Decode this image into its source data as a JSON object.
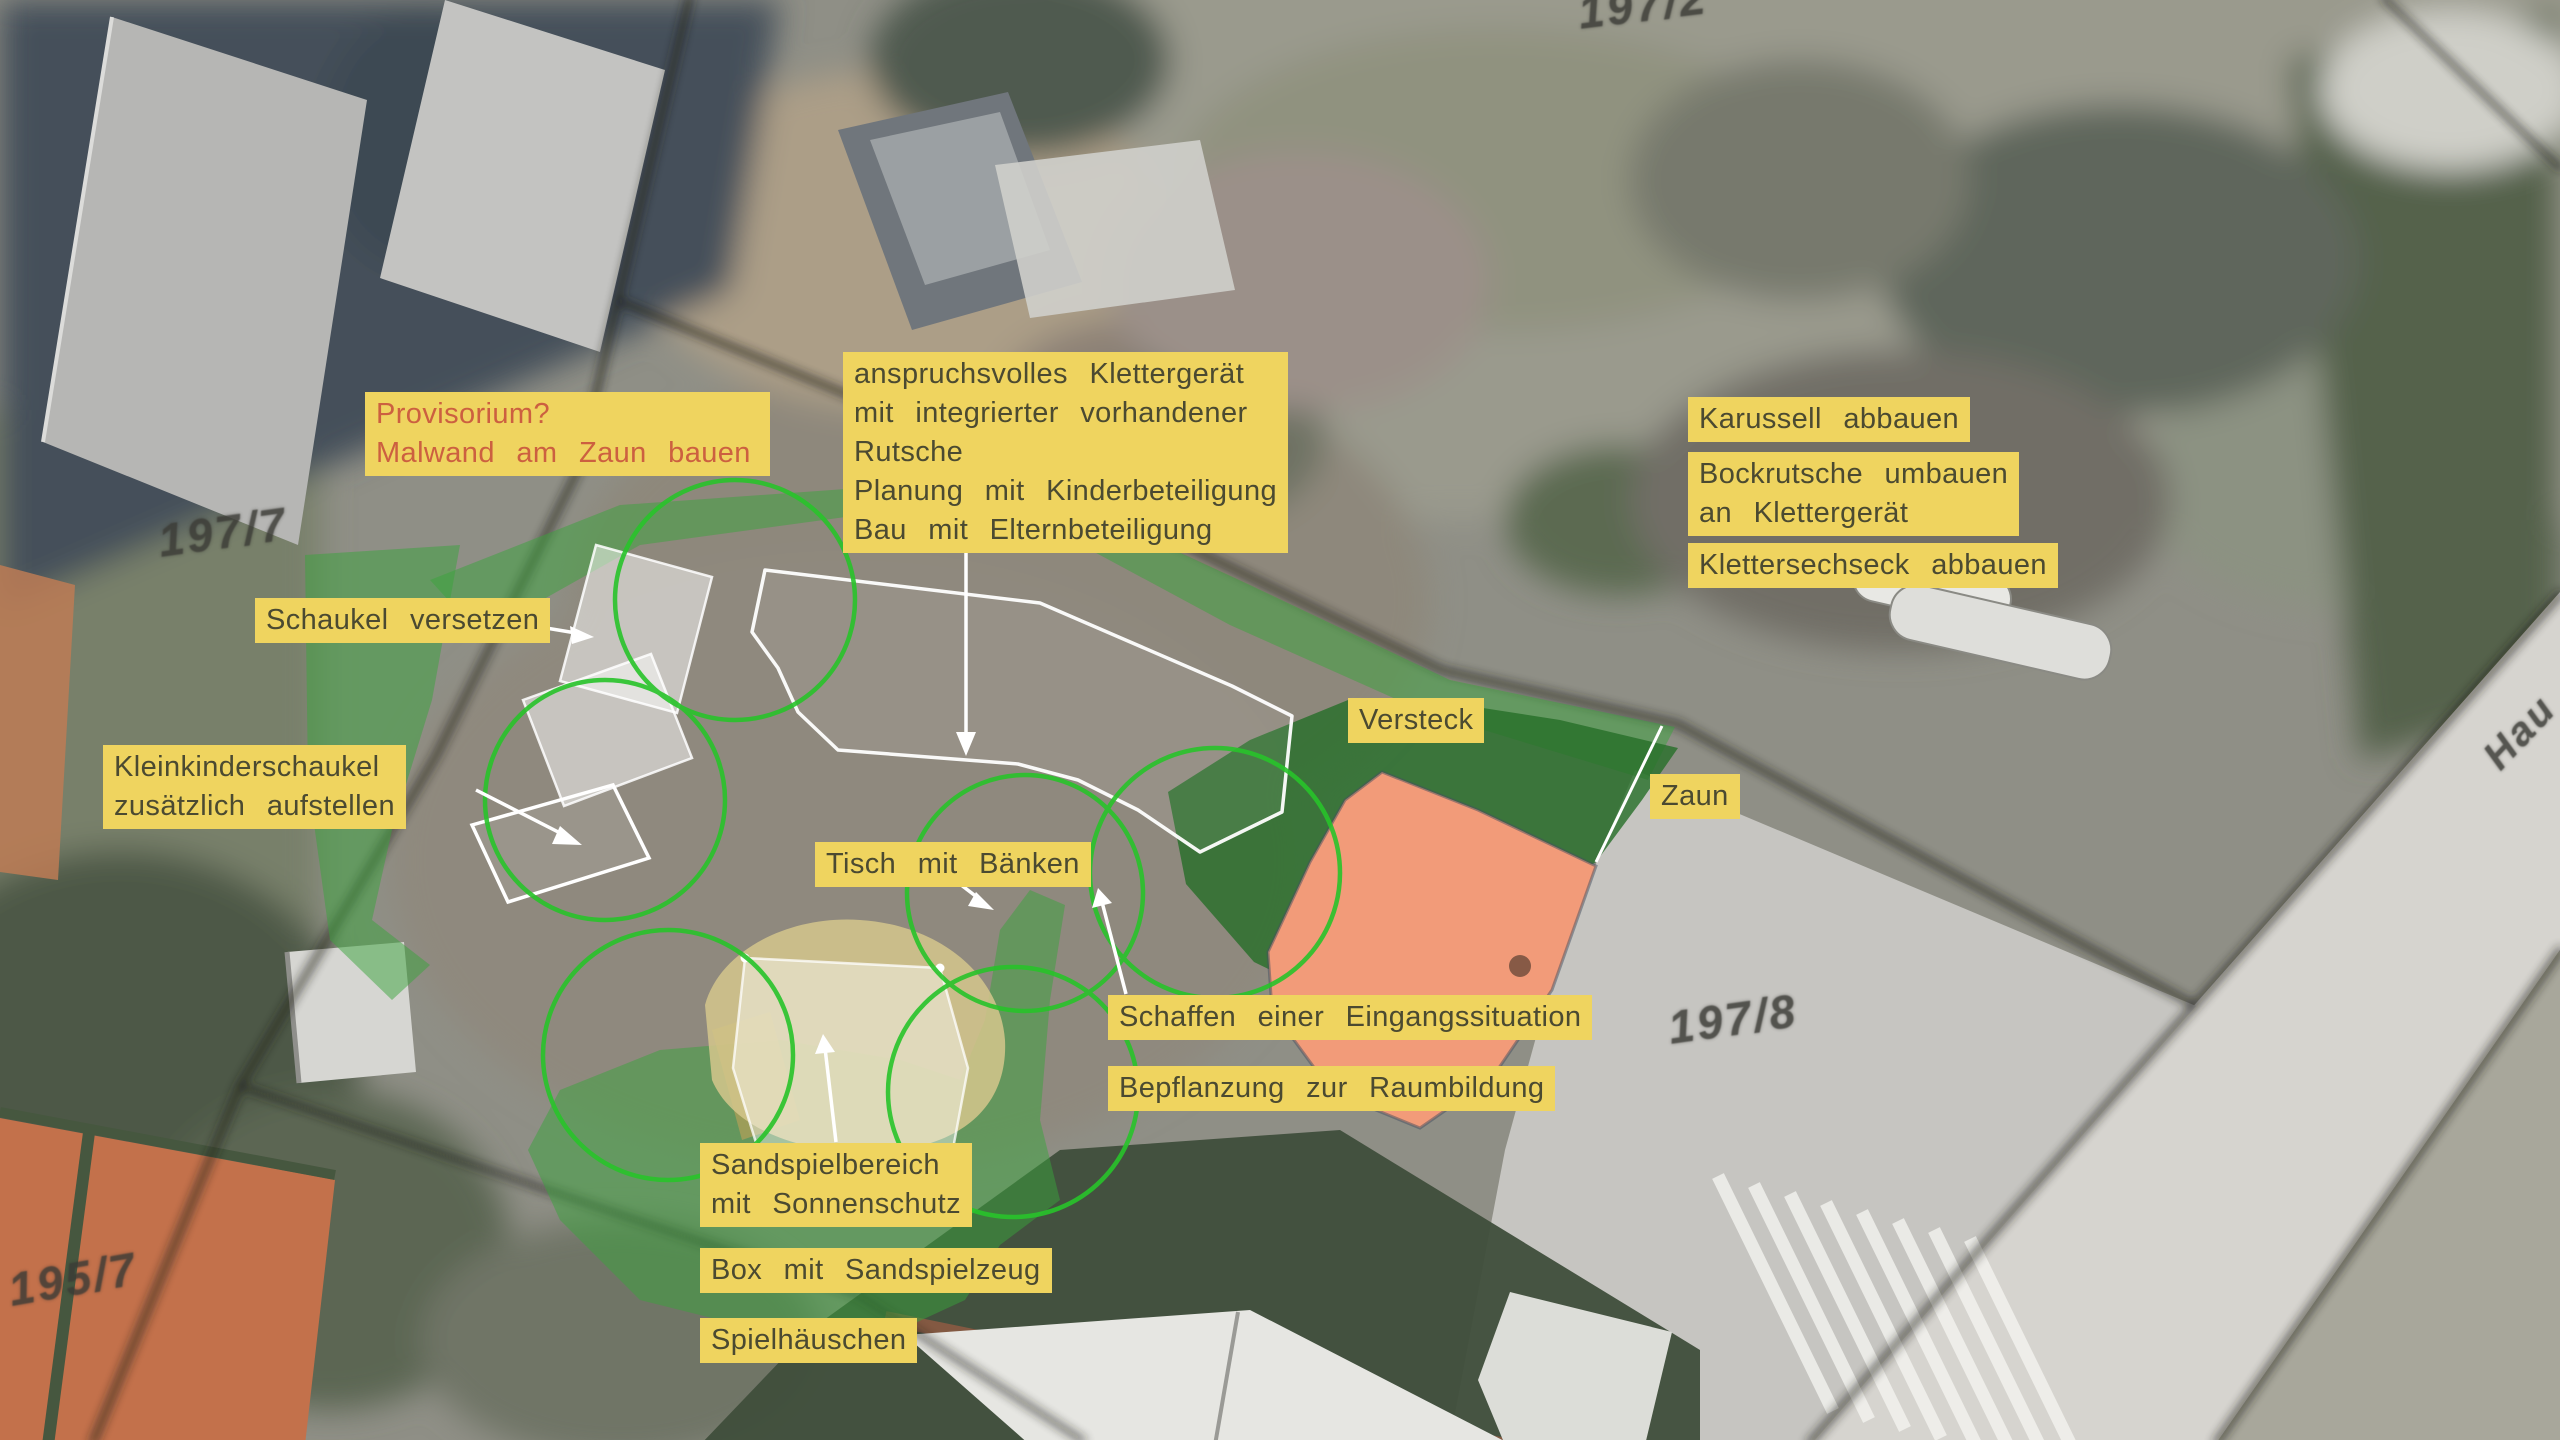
{
  "plan": {
    "type": "playground-redesign-aerial-plan",
    "language": "de"
  },
  "parcels": {
    "p197_7": "197/7",
    "p197_2": "197/2",
    "p197_8": "197/8",
    "p195_7": "195/7",
    "street": "Hau"
  },
  "notes": {
    "provisorium": {
      "lines": [
        "Provisorium?",
        "Malwand am Zaun bauen"
      ],
      "style": "alert"
    },
    "klettergeraet": {
      "lines": [
        "anspruchsvolles Klettergerät",
        "mit integrierter vorhandener",
        "Rutsche",
        "Planung mit Kinderbeteiligung",
        "Bau mit Elternbeteiligung"
      ]
    },
    "karussell": {
      "lines": [
        "Karussell abbauen"
      ]
    },
    "bockrutsche": {
      "lines": [
        "Bockrutsche umbauen",
        "an Klettergerät"
      ]
    },
    "klettersechseck": {
      "lines": [
        "Klettersechseck abbauen"
      ]
    },
    "schaukel": {
      "lines": [
        "Schaukel versetzen"
      ]
    },
    "kleinkinderschaukel": {
      "lines": [
        "Kleinkinderschaukel",
        "zusätzlich aufstellen"
      ]
    },
    "tisch": {
      "lines": [
        "Tisch mit Bänken"
      ]
    },
    "versteck": {
      "lines": [
        "Versteck"
      ]
    },
    "zaun": {
      "lines": [
        "Zaun"
      ]
    },
    "eingang": {
      "lines": [
        "Schaffen einer Eingangssituation"
      ]
    },
    "bepflanzung": {
      "lines": [
        "Bepflanzung zur Raumbildung"
      ]
    },
    "sandspielbereich": {
      "lines": [
        "Sandspielbereich",
        "mit Sonnenschutz"
      ]
    },
    "box": {
      "lines": [
        "Box mit Sandspielzeug"
      ]
    },
    "spielhaeuschen": {
      "lines": [
        "Spielhäuschen"
      ]
    }
  },
  "theme": {
    "label_bg": "#efd45f",
    "label_text": "#4b4a31",
    "alert_text": "#cc6040",
    "parcel_text": "#3b3b36",
    "zone_ring": "#28c32a",
    "overlay_green": "#3aa33b",
    "overlay_dark_green": "#266e28",
    "highlight_salmon": "#f29b79",
    "sand_fill": "#d5c78c",
    "boundary_black": "#21211e",
    "marker_white": "#ffffff"
  }
}
